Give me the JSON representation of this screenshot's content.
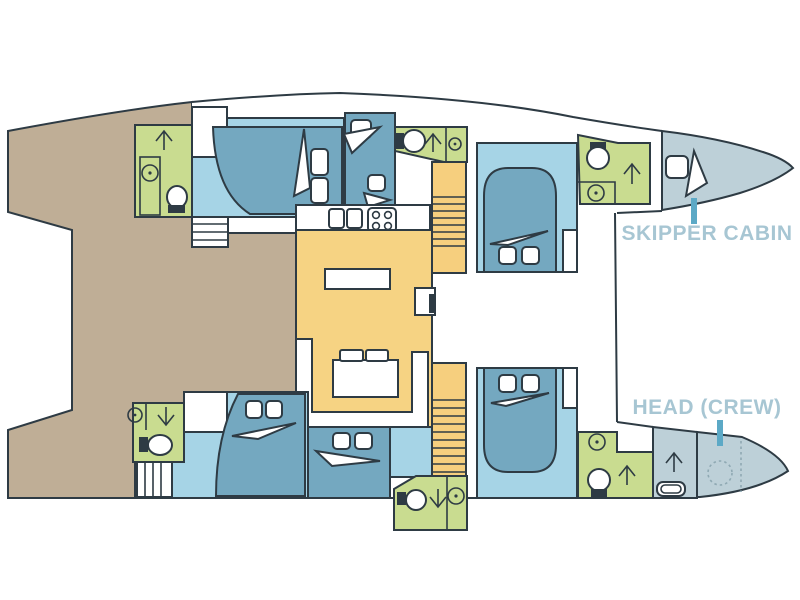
{
  "diagram": {
    "type": "catamaran-deck-plan",
    "labels": {
      "skipper_cabin": "SKIPPER CABIN",
      "head_crew": "HEAD (CREW)"
    },
    "colors": {
      "outline": "#2e3b44",
      "deck_tan": "#bfae96",
      "cabin_floor_blue": "#a6d4e6",
      "bed_blue": "#74a8c0",
      "bathroom_green": "#c9dc90",
      "salon_yellow": "#f6d383",
      "stairs_yellow": "#f6cf7e",
      "bow_gray_blue": "#bdd0d8",
      "label_text": "#a7c6d3",
      "pointer_teal": "#5ca9c6"
    },
    "rooms": [
      "aft-deck",
      "port-aft-head",
      "port-aft-cabin",
      "port-mid-cabin",
      "port-companionway-stairs",
      "galley",
      "salon",
      "salon-sofa",
      "starboard-head",
      "starboard-forward-cabin",
      "skipper-cabin",
      "starboard-aft-head",
      "starboard-aft-cabin",
      "starboard-mid-cabin",
      "starboard-companionway-stairs",
      "crew-head",
      "foredeck"
    ],
    "fixtures": [
      "toilet",
      "washbasin",
      "shower",
      "double-bed",
      "pillows",
      "stairs",
      "stove",
      "sink",
      "table",
      "sofa",
      "nav-seat"
    ]
  }
}
